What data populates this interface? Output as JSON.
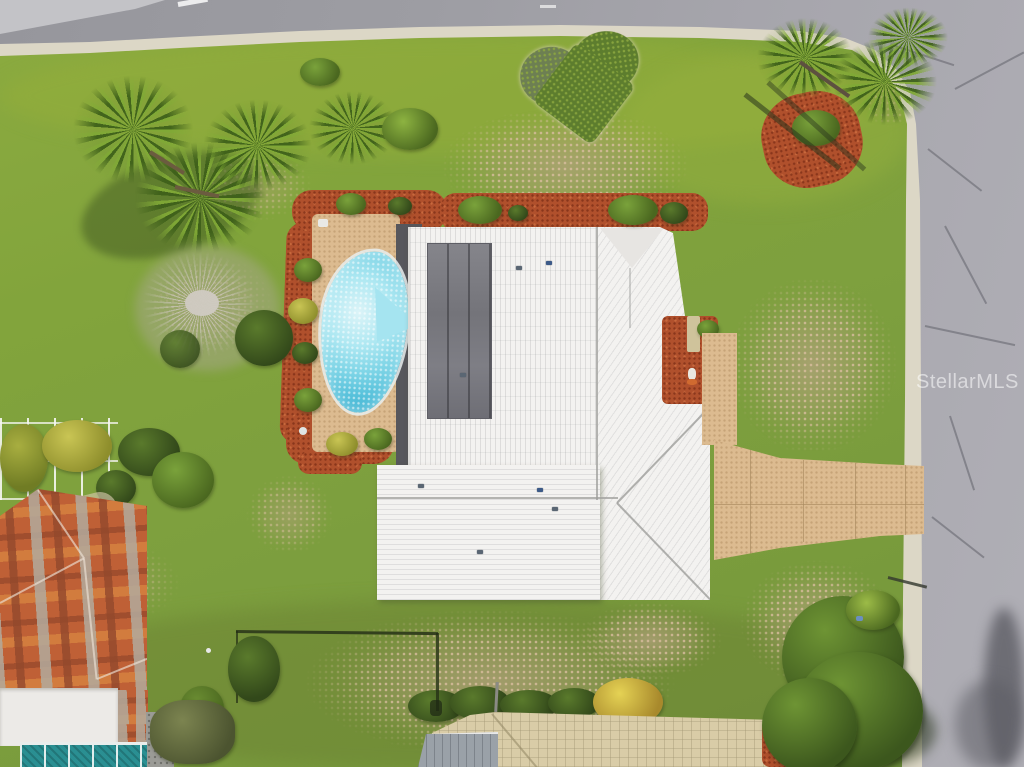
{
  "image": {
    "type": "aerial-drone-photo",
    "subject": "Top-down aerial view of a single-family home with white hip roof, screened lanai with kidney-shaped pool on a tan deck, red mulch landscaping, tan driveway meeting a road on the right, large grassy corner lot with palm trees, a leafless tree and a heart-shaped garden bed; neighboring houses at bottom-left (multicolor tile roof with teal pool cage) and bottom-center (tan tile roof)",
    "watermark": "StellarMLS"
  },
  "colors": {
    "grass": "#80a03d",
    "grass-dry": "#b5a083",
    "road": "#a4a4aa",
    "curb": "#dcd7c6",
    "roof-white": "#f3f2f0",
    "roof-panel": "#7b7b82",
    "pool-water": "#5cc6de",
    "pool-deck": "#dcbb90",
    "mulch": "#b0502c",
    "tile-roof": "#bf6036",
    "neighbor-roof": "#d9cca7",
    "pool-cage": "#2a8f92",
    "tree": "#4e7026",
    "palm": "#76a330",
    "dead-tree": "#c0b8af",
    "watermark": "rgba(255,255,255,0.55)"
  }
}
